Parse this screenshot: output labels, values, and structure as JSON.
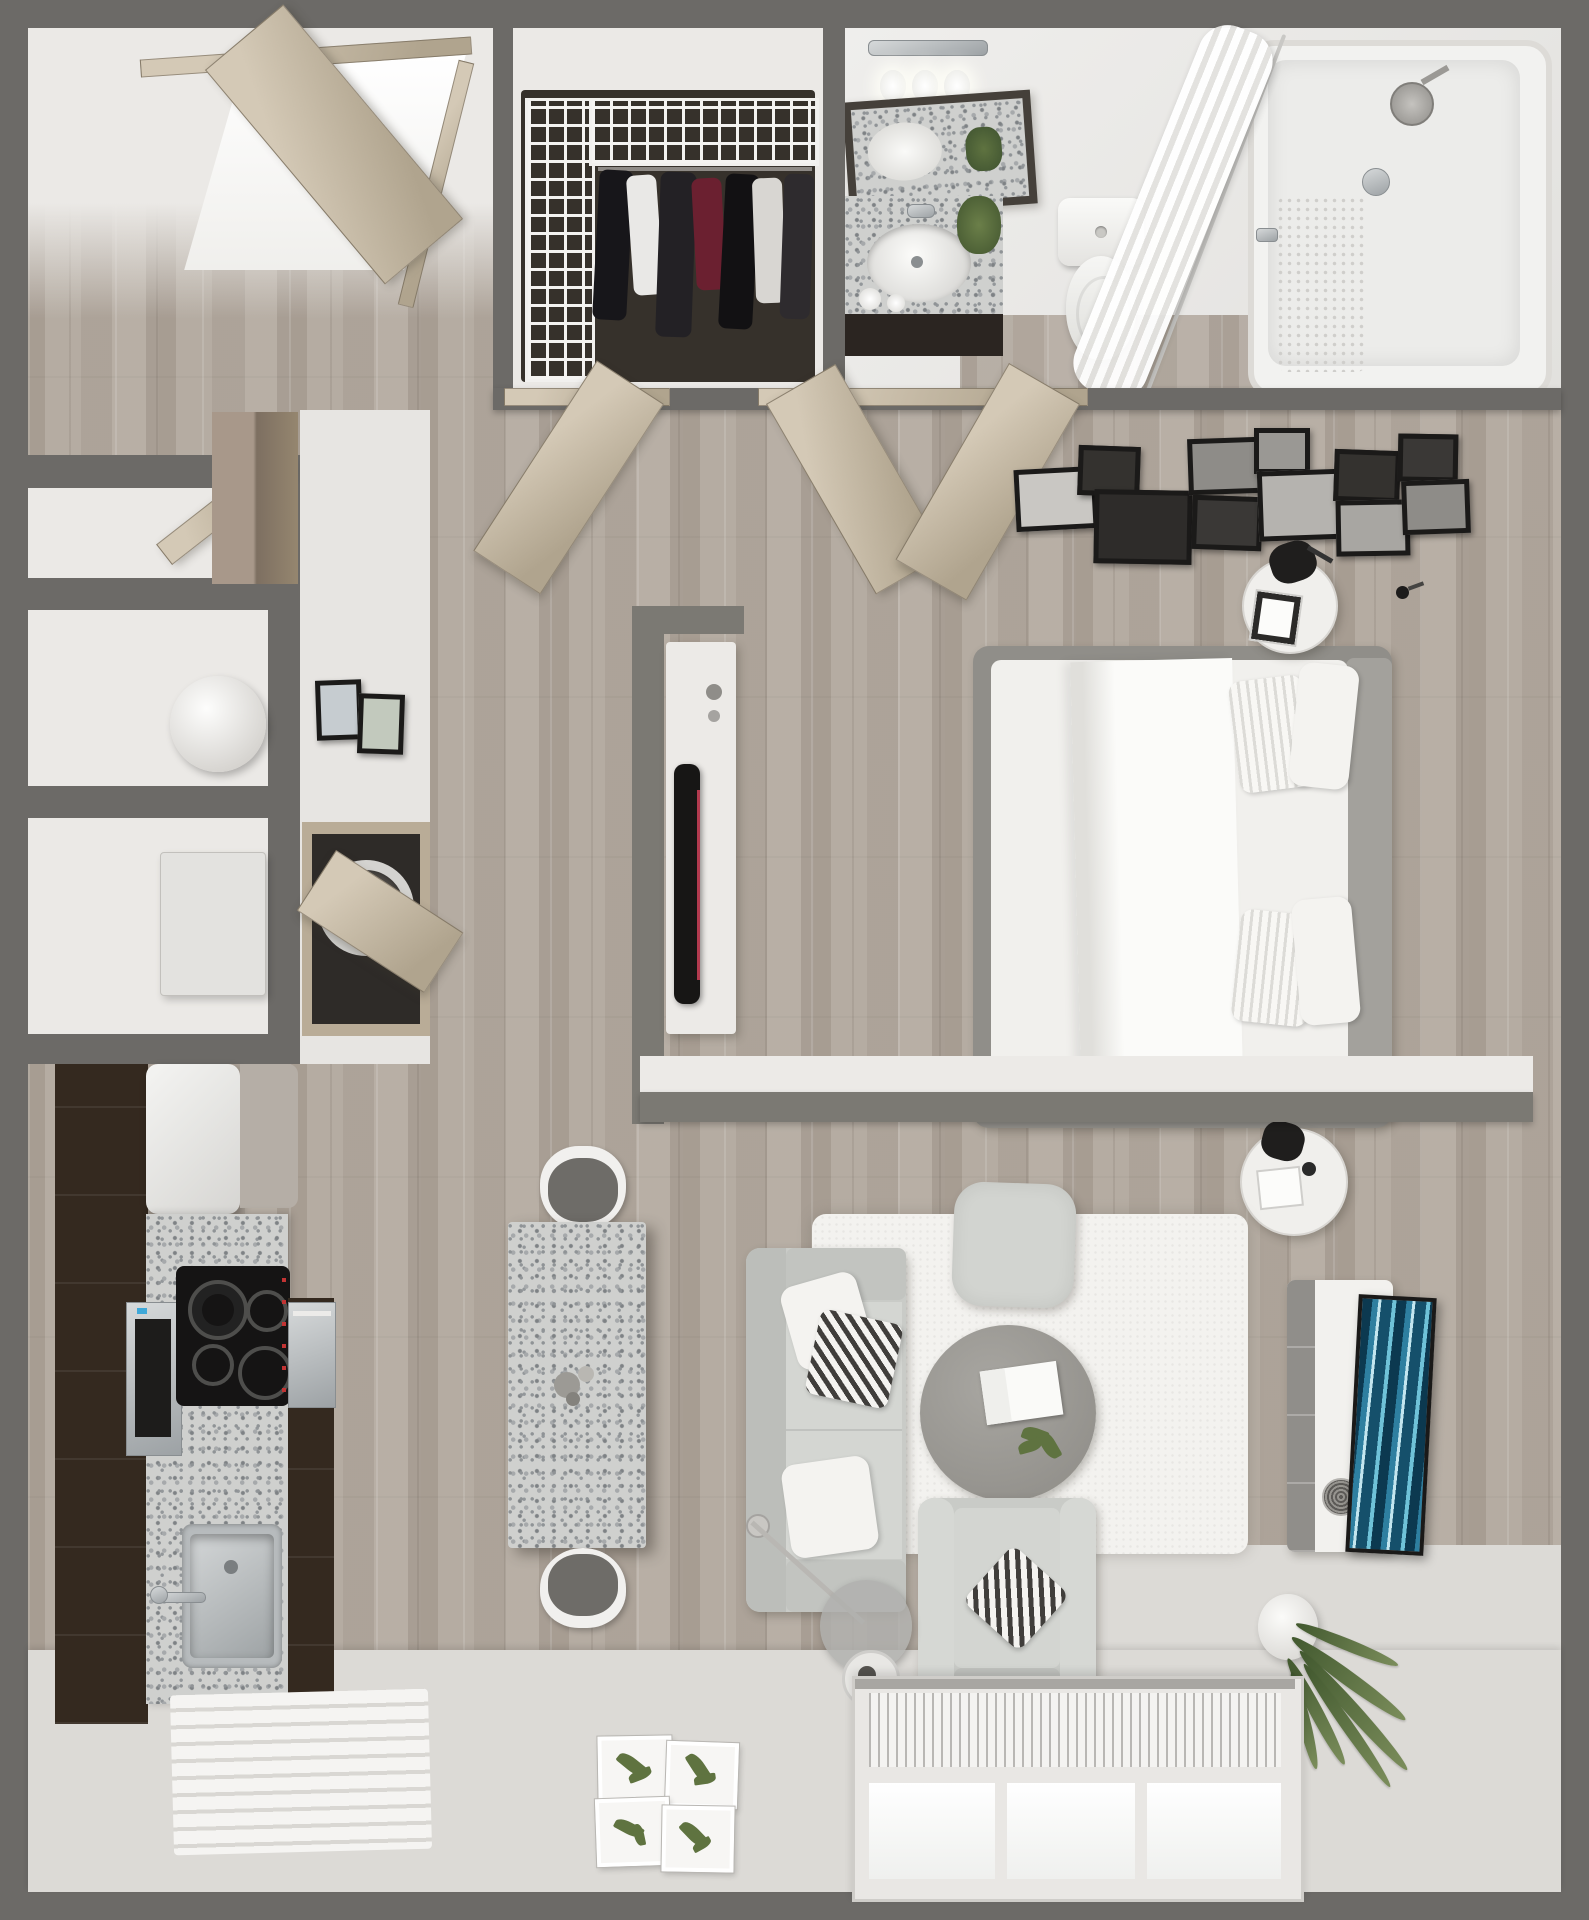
{
  "meta": {
    "title": "Studio Apartment – 3D Top-Down Floor Plan Render",
    "type": "floorplan-3d-render",
    "visible_text_in_image": "none"
  },
  "palette": {
    "wall_gray": "#6c6a67",
    "half_wall_gray": "#7b7973",
    "wood_floor": "#b2a99f",
    "light_floor": "#dcdad6",
    "door_tan": "#c7bba7",
    "cabinet_espresso": "#34291f",
    "granite_speckle": "#cfd0ce",
    "sofa_gray": "#c9cbc7",
    "bed_linen_white": "#f1f0ed",
    "tv_art_teal": "#2e7fa0",
    "plant_green": "#5a7040",
    "rug_white": "#f3f2ef"
  },
  "labels": {
    "entry": "Entry hall",
    "entry_door": "Open entry door",
    "closet": "Walk-in closet",
    "wire_shelving": "White wire closet shelving",
    "hanging_clothes": "Hanging clothes",
    "bathroom": "Bathroom",
    "vanity_light": "Vanity light bar",
    "vanity_bulb": "Vanity light bulb",
    "vanity_mirror": "Tilted vanity mirror",
    "vanity_counter": "Granite vanity counter",
    "vanity_sink": "Oval undermount sink",
    "bath_plant": "Potted plant on vanity",
    "toilet": "Toilet",
    "bathtub": "Bathtub with shower",
    "shower_curtain": "Shower curtain on curved rod",
    "shower_head": "Shower head",
    "shower_valve": "Shower valve",
    "niche_shelf": "Recessed storage niche",
    "niche_door": "Open niche door",
    "decor_sphere": "Decorative sphere",
    "storage_box": "Storage box",
    "wall_art": "Small framed wall art",
    "laundry_closet": "Laundry closet",
    "laundry_door": "Open laundry closet door",
    "washer": "Washer",
    "tall_cabinet": "Tall wood cabinet",
    "kitchen": "Kitchen",
    "fridge": "Refrigerator",
    "cabinets": "Espresso cabinet run",
    "microwave": "Built-in microwave",
    "cooktop": "Electric cooktop with four burners",
    "kitchen_counter": "Granite kitchen counter",
    "kitchen_sink": "Stainless kitchen sink",
    "kitchen_faucet": "Kitchen faucet",
    "dishwasher": "Stainless dishwasher",
    "dining_table": "Granite dining table",
    "dining_chair": "Dining chair",
    "table_centerpiece": "Table centerpiece",
    "bedroom": "Sleeping area",
    "bedroom_doors": "Open double doors",
    "hall_door": "Open hallway door",
    "gallery_wall": "Gallery wall of framed prints",
    "wall_sconce": "Wall sconce",
    "bed": "Upholstered platform bed",
    "headboard": "Gray headboard",
    "duvet": "White duvet with folded edge",
    "bed_pillow_white": "White pillow",
    "bed_pillow_striped": "Striped accent pillow",
    "nightstand": "Round nightstand",
    "table_lamp": "Black table lamp",
    "night_book": "Bedside book",
    "half_wall": "Gray half wall",
    "desk": "White desk dresser",
    "desk_tv": "Flat-screen TV on desk",
    "living": "Living area",
    "sofa": "Light gray loveseat",
    "sofa_pillow_white": "White throw pillow",
    "sofa_pillow_chevron": "Chevron throw pillow",
    "shag_rug": "White shag rug",
    "ottoman": "Square ottoman",
    "coffee_table": "Round coffee table",
    "coffee_book": "Open book on table",
    "table_plant": "Small plant on table",
    "armchair": "Light gray armchair",
    "floor_lamp": "Arc floor lamp",
    "media_console": "White media console",
    "speaker": "Speaker",
    "wall_tv": "TV with abstract blue art",
    "potted_plant": "Potted floor plant",
    "window": "Large window with blinds",
    "striped_mat": "Striped floor mat",
    "botanical_print": "Botanical leaf print"
  },
  "rooms": [
    {
      "id": "entry",
      "label": "Entry hall",
      "items": [
        "entry_door"
      ]
    },
    {
      "id": "closet",
      "label": "Walk-in closet",
      "items": [
        "wire_shelving",
        "hanging_clothes"
      ]
    },
    {
      "id": "bathroom",
      "label": "Bathroom",
      "items": [
        "vanity_light",
        "vanity_mirror",
        "vanity_counter",
        "vanity_sink",
        "bath_plant",
        "toilet",
        "bathtub",
        "shower_curtain",
        "shower_head",
        "shower_valve"
      ]
    },
    {
      "id": "storage",
      "label": "Storage niches and laundry",
      "items": [
        "niche_door",
        "decor_sphere",
        "storage_box",
        "wall_art",
        "laundry_door",
        "washer",
        "tall_cabinet"
      ]
    },
    {
      "id": "kitchen",
      "label": "Kitchen",
      "items": [
        "fridge",
        "cabinets",
        "microwave",
        "cooktop",
        "kitchen_counter",
        "kitchen_sink",
        "kitchen_faucet",
        "dishwasher"
      ]
    },
    {
      "id": "dining",
      "label": "Dining nook",
      "items": [
        "dining_table",
        "dining_chair",
        "table_centerpiece"
      ]
    },
    {
      "id": "bedroom",
      "label": "Sleeping area",
      "items": [
        "bedroom_doors",
        "gallery_wall",
        "wall_sconce",
        "bed",
        "headboard",
        "duvet",
        "bed_pillow_white",
        "bed_pillow_striped",
        "nightstand",
        "table_lamp",
        "half_wall",
        "desk",
        "desk_tv"
      ]
    },
    {
      "id": "living",
      "label": "Living area",
      "items": [
        "sofa",
        "sofa_pillow_white",
        "sofa_pillow_chevron",
        "shag_rug",
        "ottoman",
        "coffee_table",
        "coffee_book",
        "table_plant",
        "armchair",
        "floor_lamp",
        "media_console",
        "speaker",
        "wall_tv",
        "potted_plant",
        "window",
        "striped_mat",
        "botanical_print"
      ]
    }
  ]
}
